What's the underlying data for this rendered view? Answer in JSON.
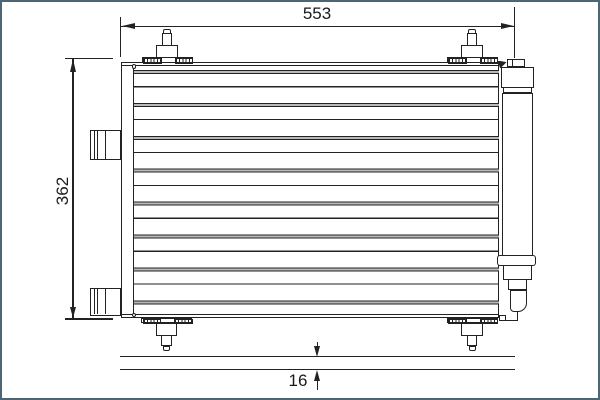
{
  "diagram": {
    "dimensions": {
      "width": "553",
      "height": "362",
      "depth": "16"
    },
    "colors": {
      "frame": "#4d6673",
      "line": "#222222",
      "tube": "#b9b9b9",
      "background": "#ffffff"
    }
  }
}
